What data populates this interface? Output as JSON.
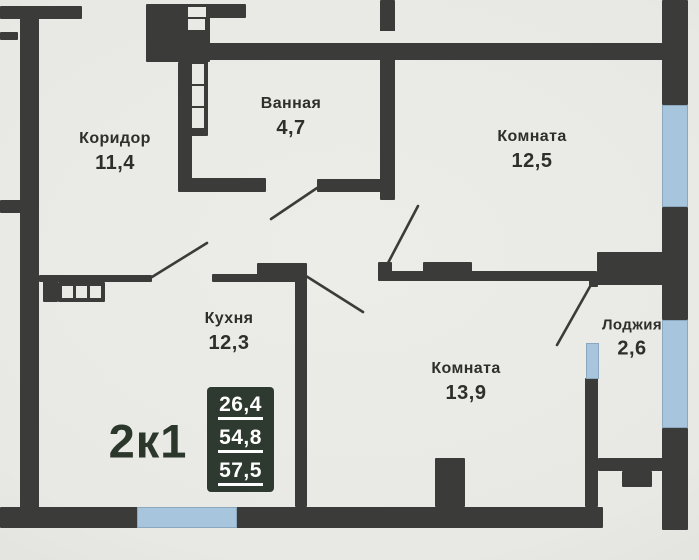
{
  "plan": {
    "unit_type": "2к1",
    "areas_badge": {
      "values": [
        "26,4",
        "54,8",
        "57,5"
      ]
    },
    "rooms": [
      {
        "name": "Коридор",
        "area": "11,4"
      },
      {
        "name": "Ванная",
        "area": "4,7"
      },
      {
        "name": "Комната",
        "area": "12,5"
      },
      {
        "name": "Кухня",
        "area": "12,3"
      },
      {
        "name": "Комната",
        "area": "13,9"
      },
      {
        "name": "Лоджия",
        "area": "2,6"
      }
    ]
  },
  "colors": {
    "wall": "#3b3b39",
    "window": "#a7c6dd",
    "paper": "#e8e8e4",
    "badge_bg": "#2e3a2f",
    "badge_text": "#ffffff",
    "label_text": "#2e2e2c",
    "unit_label_text": "#2c372c"
  }
}
